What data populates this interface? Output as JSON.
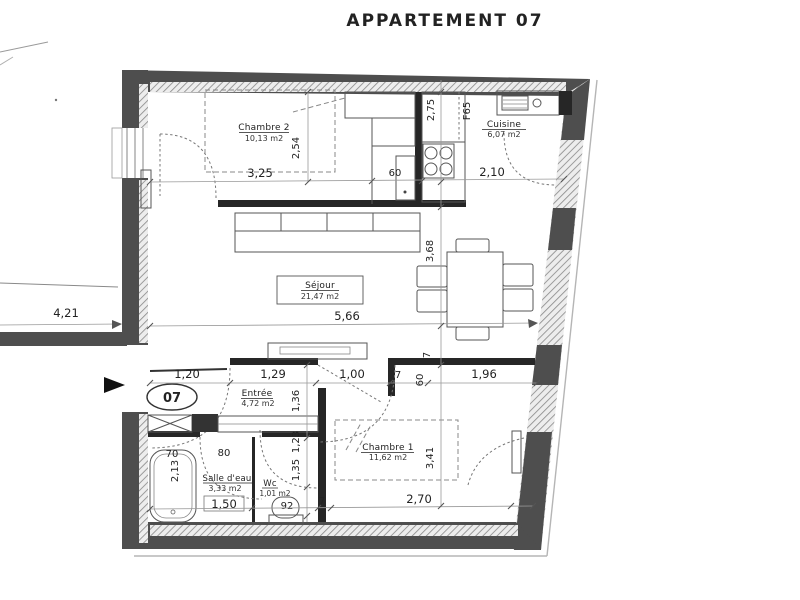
{
  "title": "APPARTEMENT 07",
  "badge": "07",
  "rooms": {
    "chambre2": {
      "name": "Chambre 2",
      "area": "10,13 m2"
    },
    "cuisine": {
      "name": "Cuisine",
      "area": "6,07 m2"
    },
    "sejour": {
      "name": "Séjour",
      "area": "21,47 m2"
    },
    "entree": {
      "name": "Entrée",
      "area": "4,72 m2"
    },
    "chambre1": {
      "name": "Chambre 1",
      "area": "11,62 m2"
    },
    "salle_deau": {
      "name": "Salle d'eau",
      "area": "3,33 m2"
    },
    "wc": {
      "name": "Wc",
      "area": "1,01 m2"
    }
  },
  "dims": {
    "corridor": "4,21",
    "chambre2_width": "3,25",
    "chambre2_depth": "2,54",
    "closet": "60",
    "cuisine_width": "2,10",
    "cuisine_depth": "2,75",
    "fridge": "F65",
    "sejour_width": "5,66",
    "sejour_depth": "3,68",
    "entree_1": "1,20",
    "entree_2": "1,29",
    "entree_3": "1,00",
    "wall_a": "7",
    "stub": "60",
    "entree_4": "1,96",
    "wall_b": "7",
    "col_1": "1,36",
    "col_2": "1,23",
    "col_3": "1,35",
    "tub_width": "70",
    "sde_door": "80",
    "tub_length": "2,13",
    "sde_width": "1,50",
    "wc_width": "92",
    "wall_c": "7",
    "chambre1_width": "2,70",
    "chambre1_depth": "3,41"
  },
  "colors": {
    "wall": "#4e4e4e",
    "partition": "#262626",
    "ink": "#1c1c1c"
  }
}
